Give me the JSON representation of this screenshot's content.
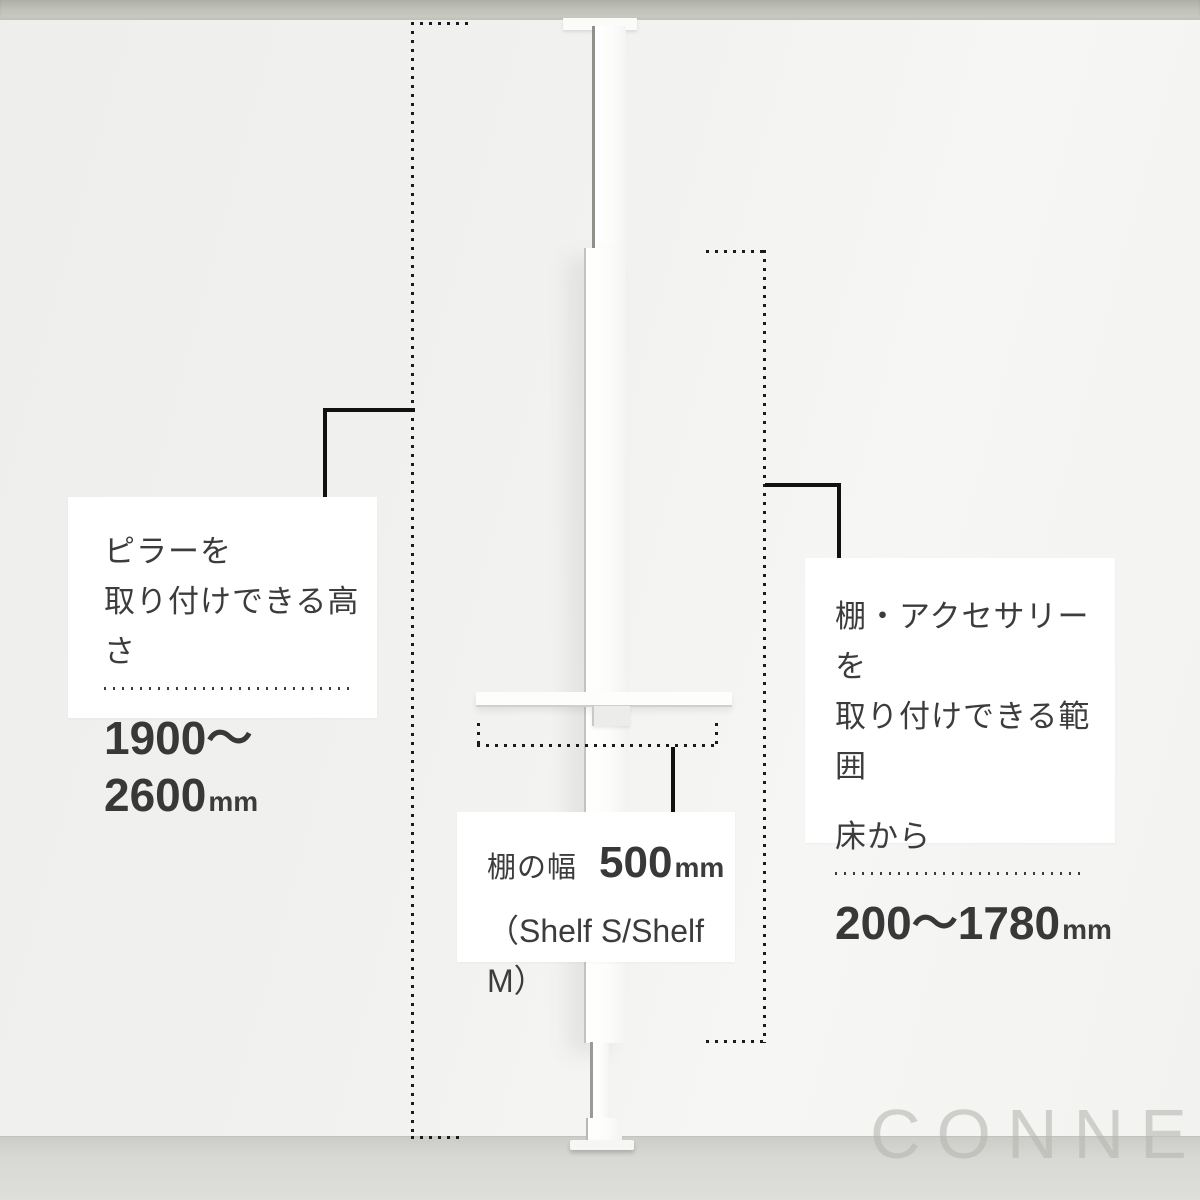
{
  "scene": {
    "watermark": "CONNECT",
    "description": "tension-pole-shelf-dimension-diagram"
  },
  "annotations": {
    "pillar_height": {
      "line1": "ピラーを",
      "line2": "取り付けできる高さ",
      "value": "1900〜2600",
      "unit": "mm"
    },
    "accessory_range": {
      "line1": "棚・アクセサリーを",
      "line2": "取り付けできる範囲",
      "line3": "床から",
      "value": "200〜1780",
      "unit": "mm"
    },
    "shelf_width": {
      "label": "棚の幅",
      "value": "500",
      "unit": "mm",
      "note": "（Shelf S/Shelf M）"
    }
  },
  "colors": {
    "wall": "#f2f2f0",
    "ceiling": "#bfc0b8",
    "floor": "#d8d8d4",
    "box": "#ffffff",
    "text": "#3c3c3c",
    "guide_dots": "#1b1b1b",
    "connector": "#111111"
  }
}
